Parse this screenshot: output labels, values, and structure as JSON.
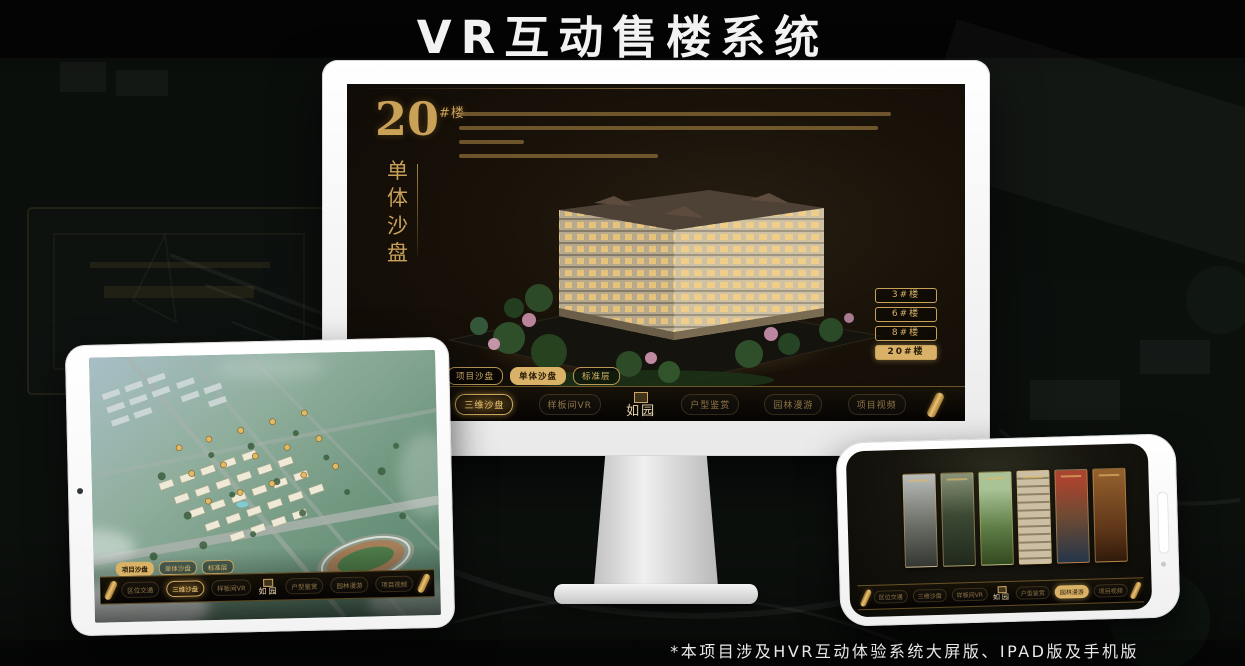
{
  "page": {
    "title": "VR互动售楼系统",
    "footnote": "*本项目涉及HVR互动体验系统大屏版、IPAD版及手机版"
  },
  "brand": {
    "logo": "如园"
  },
  "colors": {
    "gold": "#d2a85c",
    "gold_bright": "#ecc878",
    "gold_fill": "#d9b267",
    "selected_text": "#241806",
    "screen_bg": "#171108",
    "title_white": "#f2f2f2"
  },
  "desktop": {
    "headline": {
      "number": "20",
      "unit": "#楼",
      "vertical_title": "单体沙盘"
    },
    "building_buttons": [
      {
        "label": "3#楼",
        "selected": false
      },
      {
        "label": "6#楼",
        "selected": false
      },
      {
        "label": "8#楼",
        "selected": false
      },
      {
        "label": "20#楼",
        "selected": true
      }
    ],
    "sub_tabs": [
      {
        "label": "项目沙盘",
        "selected": false
      },
      {
        "label": "单体沙盘",
        "selected": true
      },
      {
        "label": "标准层",
        "selected": false
      }
    ],
    "nav_items": [
      {
        "label": "区位交通",
        "active": false
      },
      {
        "label": "三维沙盘",
        "active": true
      },
      {
        "label": "样板间VR",
        "active": false
      },
      {
        "label": "户型鉴赏",
        "active": false
      },
      {
        "label": "园林漫游",
        "active": false
      },
      {
        "label": "项目视频",
        "active": false
      }
    ]
  },
  "tablet": {
    "sub_tabs": [
      {
        "label": "项目沙盘",
        "selected": true
      },
      {
        "label": "单体沙盘",
        "selected": false
      },
      {
        "label": "标准层",
        "selected": false
      }
    ],
    "nav_items": [
      {
        "label": "区位交通",
        "active": false
      },
      {
        "label": "三维沙盘",
        "active": true
      },
      {
        "label": "样板间VR",
        "active": false
      },
      {
        "label": "户型鉴赏",
        "active": false
      },
      {
        "label": "园林漫游",
        "active": false
      },
      {
        "label": "项目视频",
        "active": false
      }
    ]
  },
  "phone": {
    "nav_items": [
      {
        "label": "区位交通",
        "active": false
      },
      {
        "label": "三维沙盘",
        "active": false
      },
      {
        "label": "样板间VR",
        "active": false
      },
      {
        "label": "户型鉴赏",
        "active": false
      },
      {
        "label": "园林漫游",
        "active": true
      },
      {
        "label": "项目视频",
        "active": false
      }
    ]
  },
  "icons": {
    "scroll_handle": "gold-scroll-roll",
    "seal": "ruyuan-seal",
    "camera": "camera-dot"
  }
}
